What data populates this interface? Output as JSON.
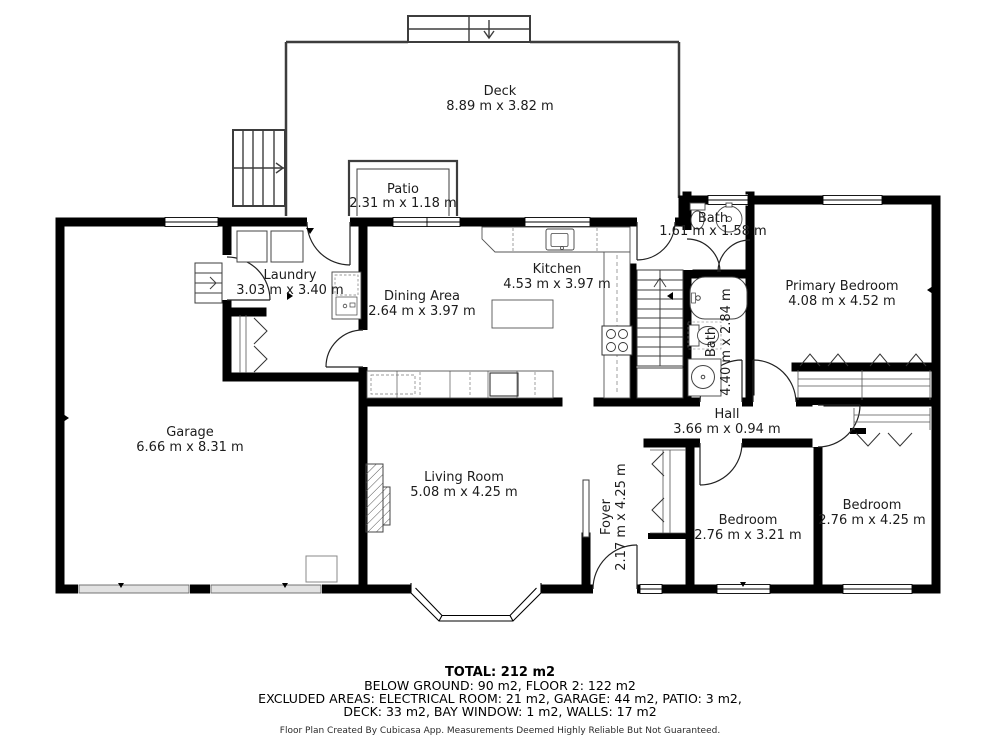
{
  "rooms": [
    {
      "name": "Deck",
      "dims": "8.89 m x 3.82 m"
    },
    {
      "name": "Patio",
      "dims": "2.31 m x 1.18 m"
    },
    {
      "name": "Laundry",
      "dims": "3.03 m x 3.40 m"
    },
    {
      "name": "Dining Area",
      "dims": "2.64 m x 3.97 m"
    },
    {
      "name": "Kitchen",
      "dims": "4.53 m x 3.97 m"
    },
    {
      "name": "Bath",
      "dims": "1.61 m x 1.58 m"
    },
    {
      "name": "Primary Bedroom",
      "dims": "4.08 m x 4.52 m"
    },
    {
      "name": "Bath",
      "dims": "4.40 m x 2.84 m"
    },
    {
      "name": "Hall",
      "dims": "3.66 m x 0.94 m"
    },
    {
      "name": "Garage",
      "dims": "6.66 m x 8.31 m"
    },
    {
      "name": "Living Room",
      "dims": "5.08 m x 4.25 m"
    },
    {
      "name": "Foyer",
      "dims": "2.17 m x 4.25 m"
    },
    {
      "name": "Bedroom",
      "dims": "2.76 m x 3.21 m"
    },
    {
      "name": "Bedroom",
      "dims": "2.76 m x 4.25 m"
    }
  ],
  "summary": {
    "total": "TOTAL: 212 m2",
    "line2": "BELOW GROUND: 90 m2, FLOOR 2: 122 m2",
    "line3": "EXCLUDED AREAS: ELECTRICAL ROOM: 21 m2, GARAGE: 44 m2, PATIO: 3 m2,",
    "line4": "DECK: 33 m2, BAY WINDOW: 1 m2, WALLS: 17 m2",
    "disclaimer": "Floor Plan Created By Cubicasa App. Measurements Deemed Highly Reliable But Not Guaranteed."
  },
  "colors": {
    "wall": "#000000",
    "thin_wall": "#3d3d3d",
    "label": "#1c1c1c"
  }
}
